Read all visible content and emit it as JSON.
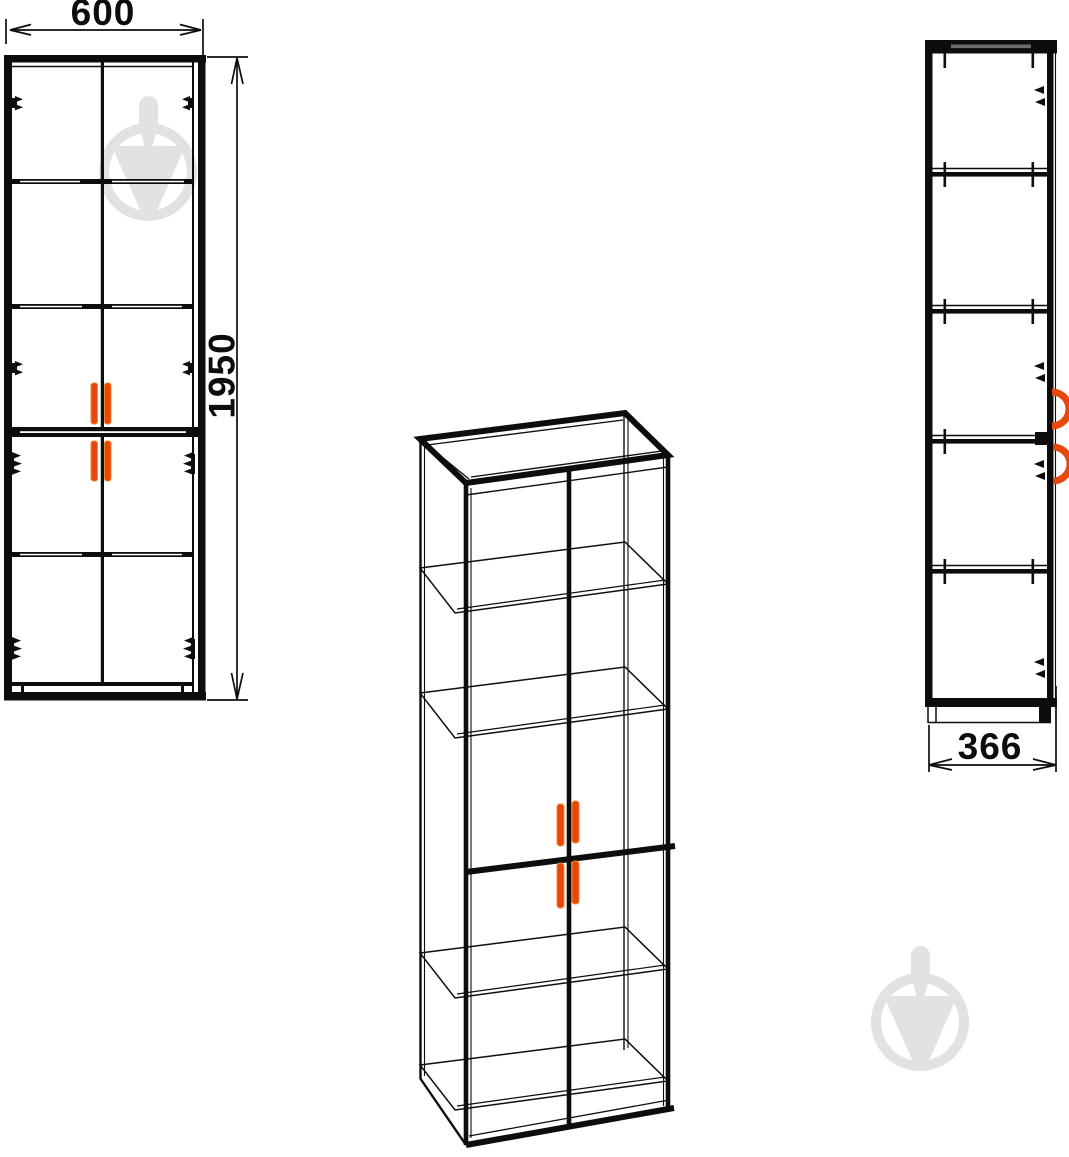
{
  "canvas": {
    "background": "#ffffff",
    "line_color": "#0d0d0d"
  },
  "dimensions": {
    "width": {
      "value": "600"
    },
    "height": {
      "value": "1950"
    },
    "depth": {
      "value": "366"
    }
  },
  "colors": {
    "handle_accent": "#e8470b",
    "watermark_gray": "#e2e2e2",
    "hardware_black": "#0d0d0d"
  },
  "icons": {
    "watermark": "trowel-in-circle-icon",
    "handle": "door-handle-bar",
    "hinge": "hinge-mark"
  }
}
